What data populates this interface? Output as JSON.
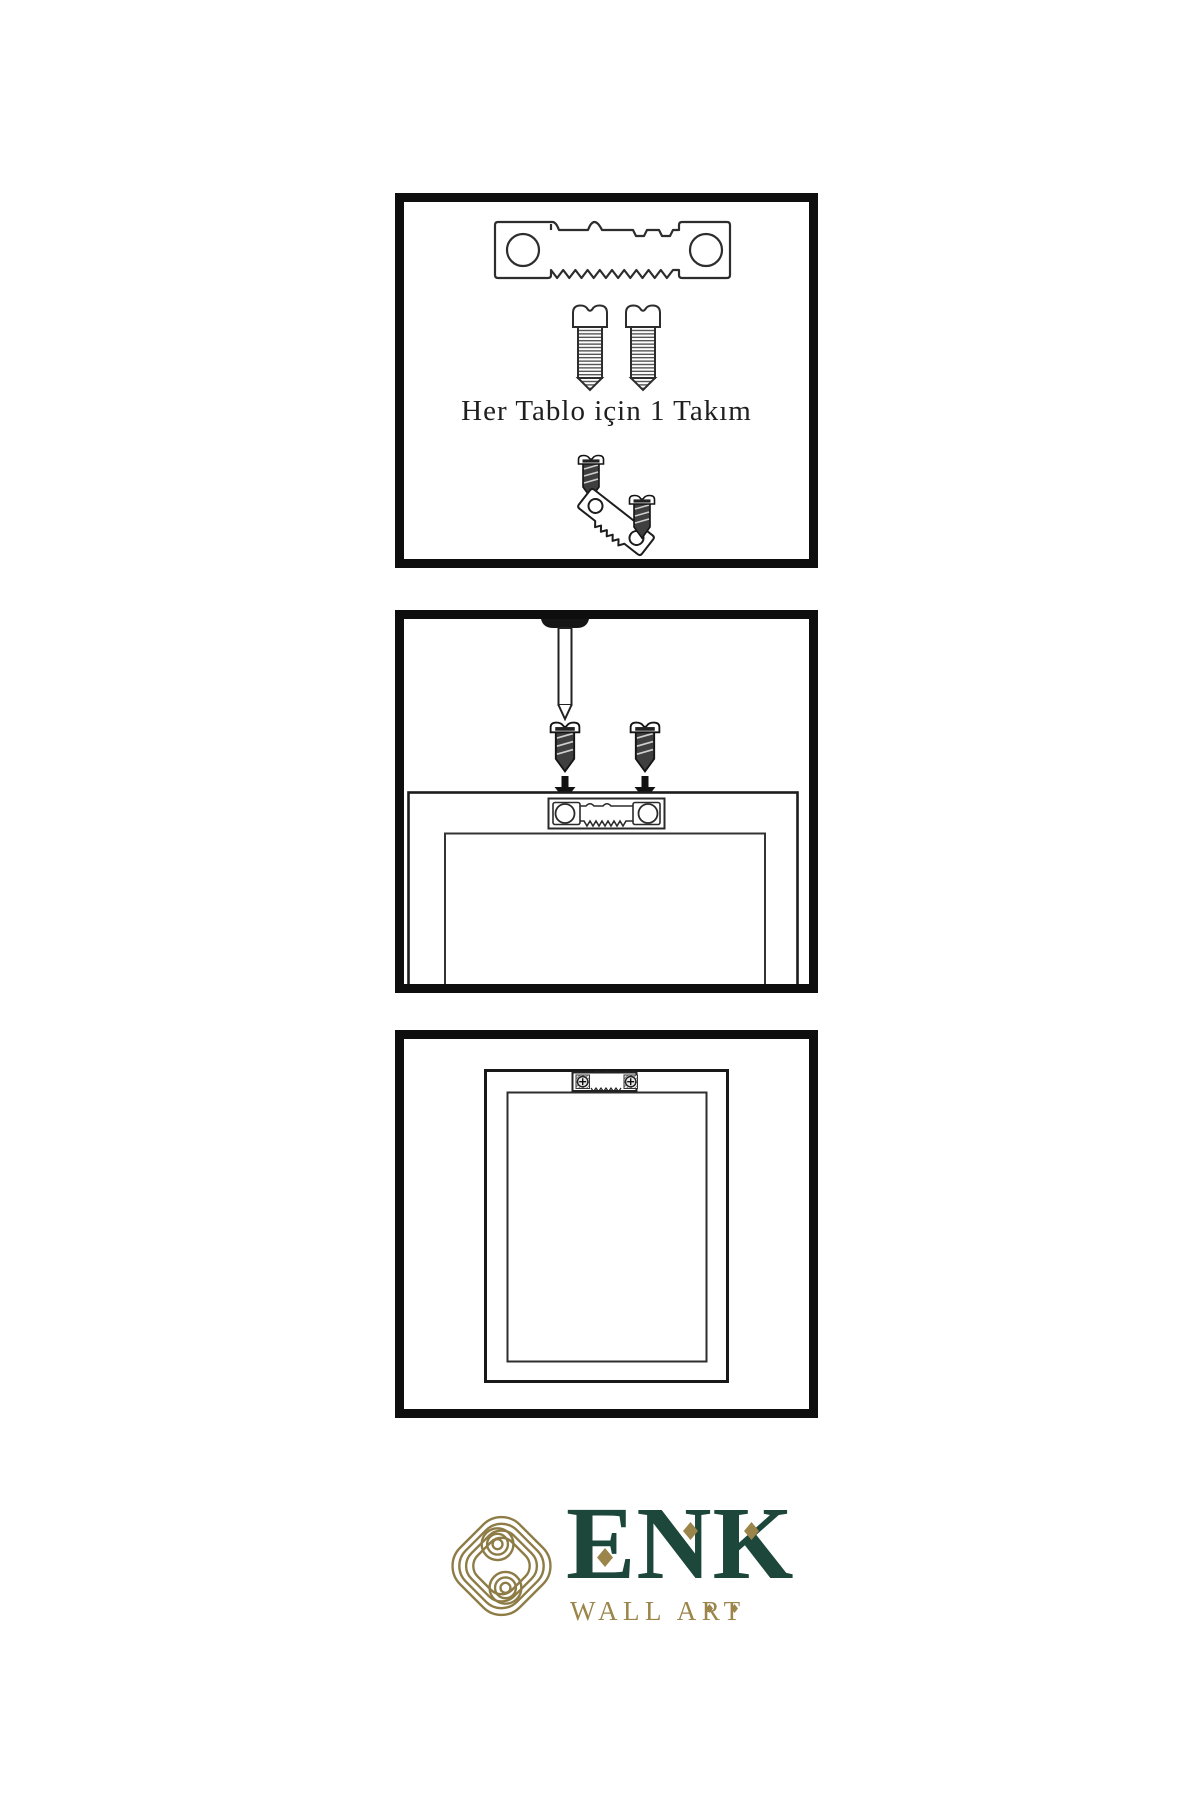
{
  "canvas": {
    "width": 1200,
    "height": 1800,
    "background": "#ffffff"
  },
  "colors": {
    "line": "#2d2d2d",
    "panel_border": "#0e0e0e",
    "dark_fill": "#3f3f3f",
    "black_fill": "#141414",
    "brand_green": "#1c473a",
    "brand_gold": "#9c854a",
    "emblem_gold": "#8e7c46"
  },
  "step1": {
    "caption": "Her Tablo için 1 Takım"
  },
  "brand": {
    "name": "ENK",
    "tagline": "WALL ART"
  },
  "icons": [
    "sawtooth-hanger-icon",
    "screw-icon",
    "dark-screw-icon",
    "tilted-sawtooth-hanger-icon",
    "nail-icon",
    "arrow-down-icon",
    "picture-frame-outline",
    "mounted-hanger-icon",
    "knot-emblem-icon",
    "diamond-accent-icon"
  ]
}
